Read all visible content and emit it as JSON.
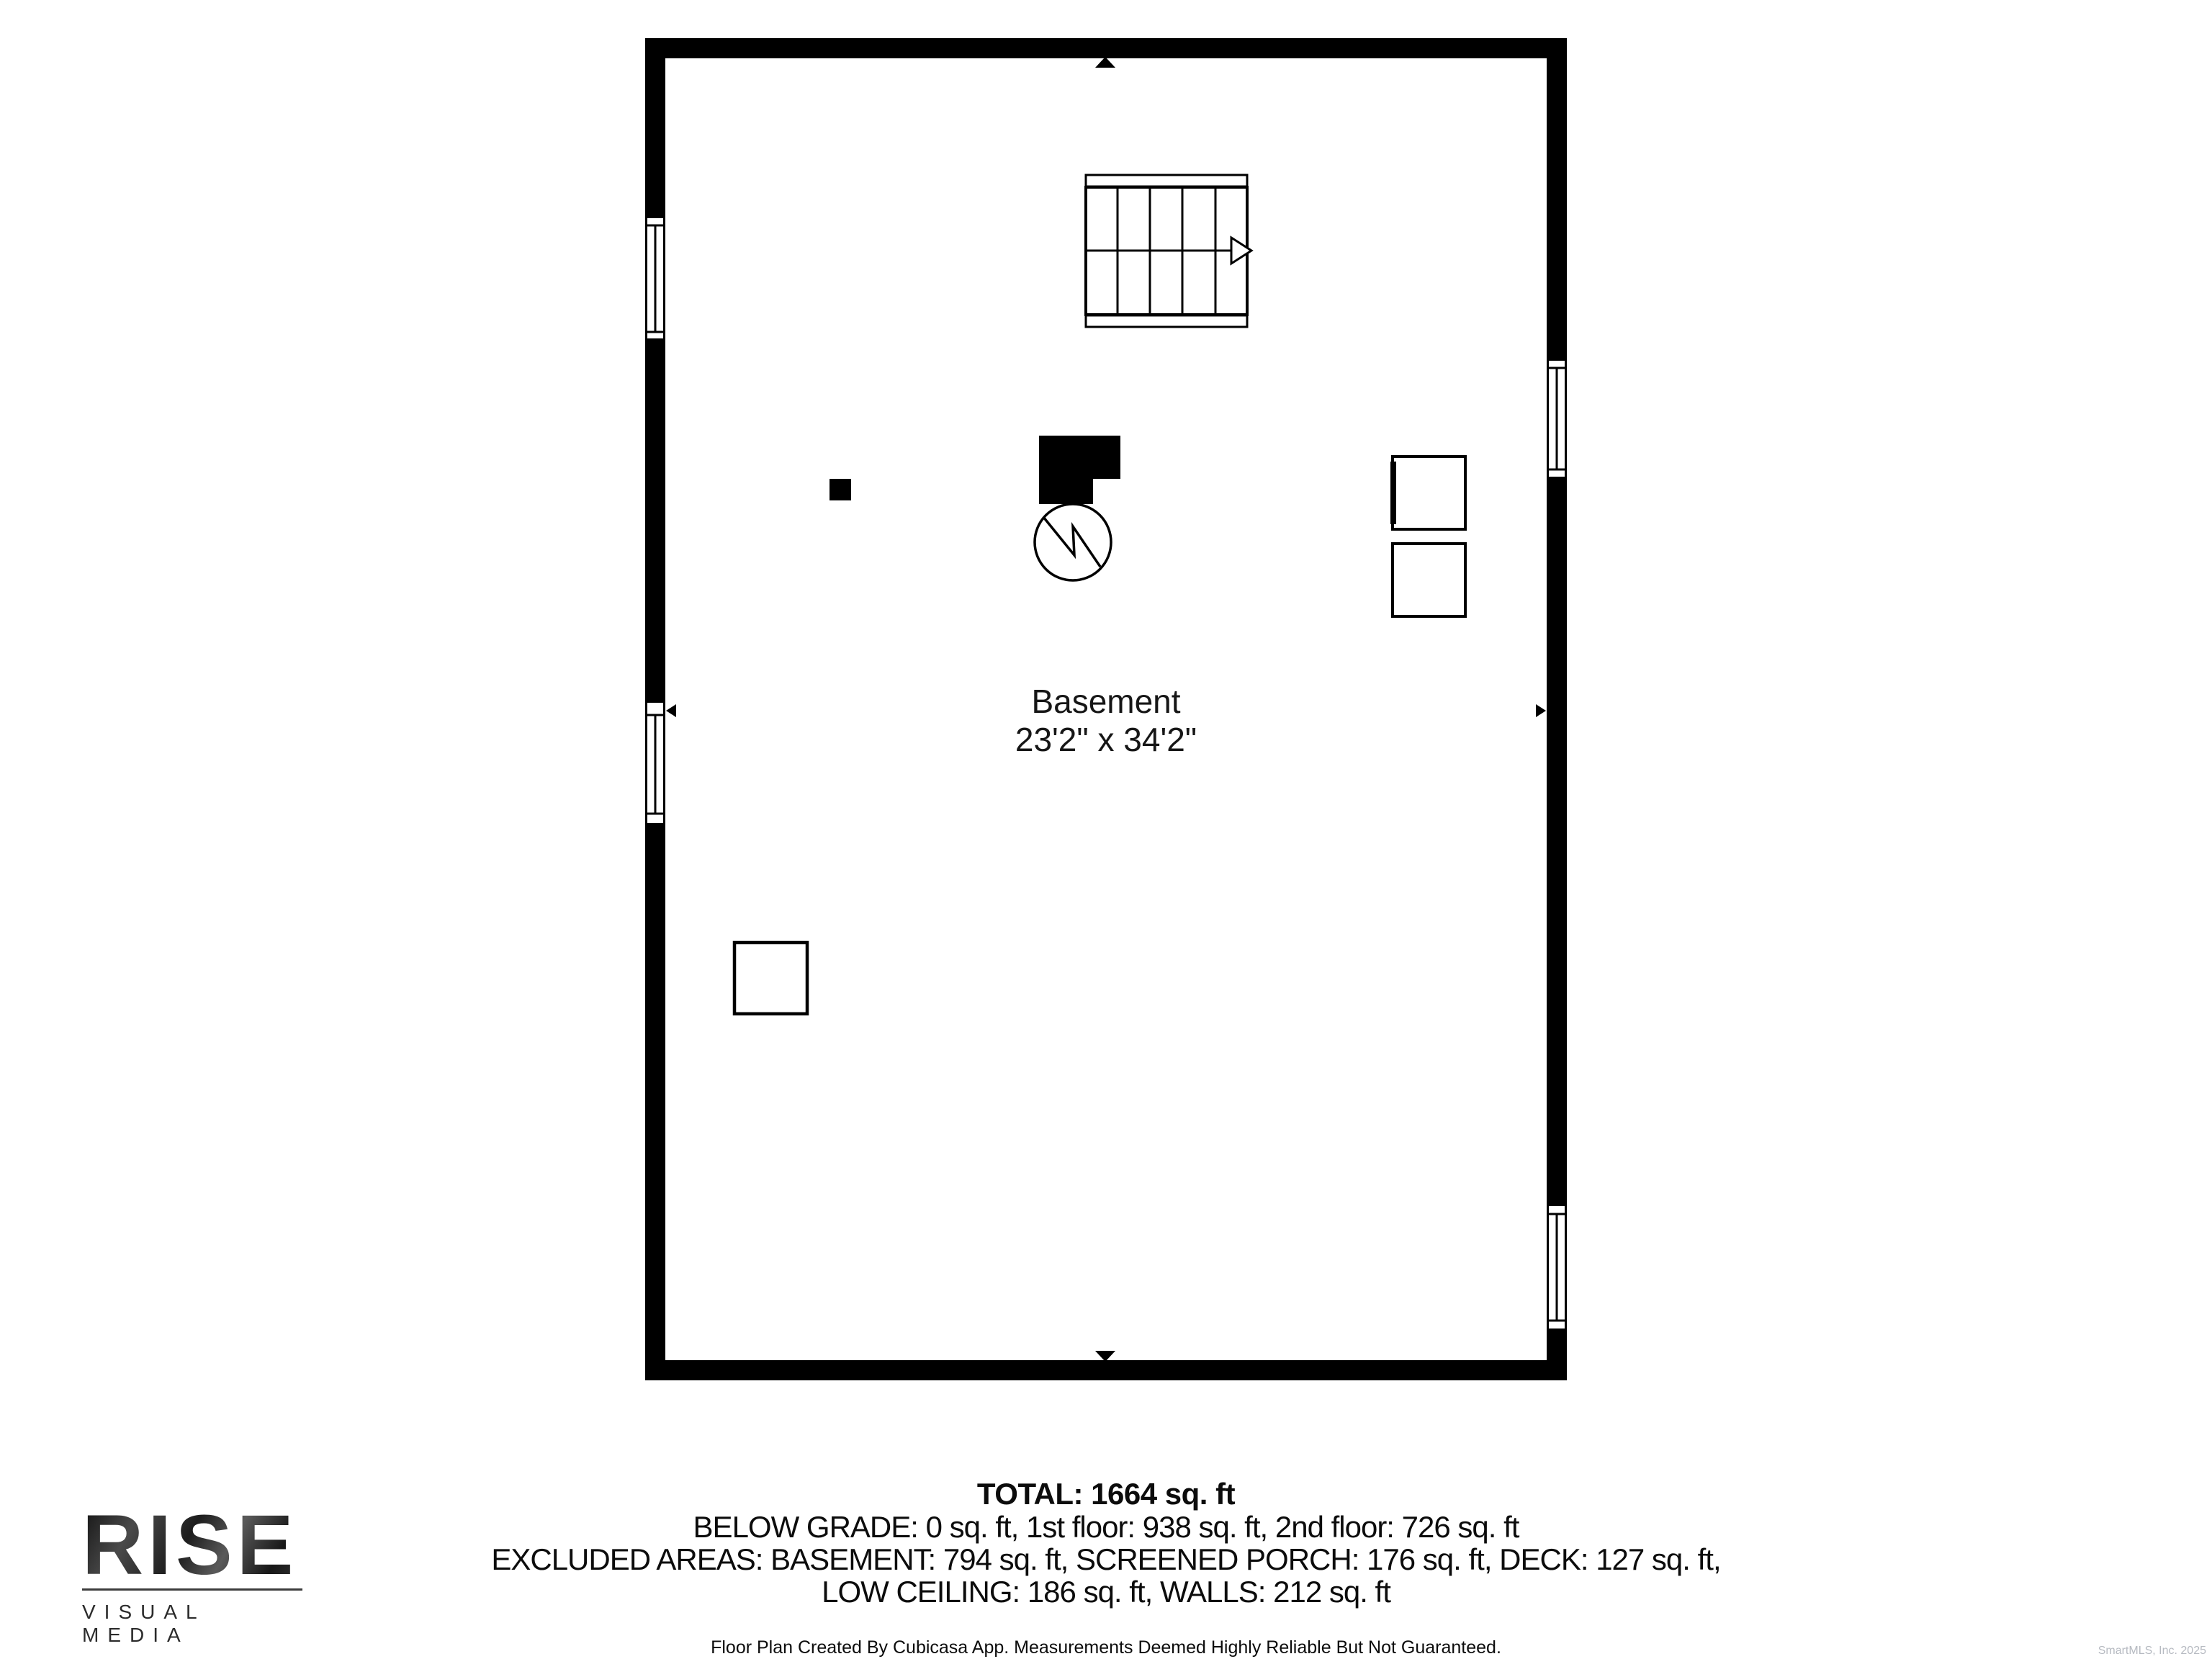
{
  "floorplan": {
    "room_label": "Basement",
    "room_dimensions": "23'2\" x 34'2\""
  },
  "summary": {
    "total": "TOTAL: 1664 sq. ft",
    "line1": "BELOW GRADE: 0 sq. ft, 1st floor: 938 sq. ft, 2nd floor: 726 sq. ft",
    "line2": "EXCLUDED AREAS: BASEMENT: 794 sq. ft, SCREENED PORCH: 176 sq. ft, DECK: 127 sq. ft,",
    "line3": "LOW CEILING: 186 sq. ft, WALLS: 212 sq. ft",
    "disclaimer": "Floor Plan Created By Cubicasa App. Measurements Deemed Highly Reliable But Not Guaranteed."
  },
  "branding": {
    "logo_title": "RISE",
    "logo_subtitle": "VISUAL MEDIA"
  },
  "watermark": "SmartMLS, Inc.  2025",
  "colors": {
    "wall": "#000000",
    "text": "#0c0c0c",
    "watermark_gray": "#b6bac1"
  }
}
